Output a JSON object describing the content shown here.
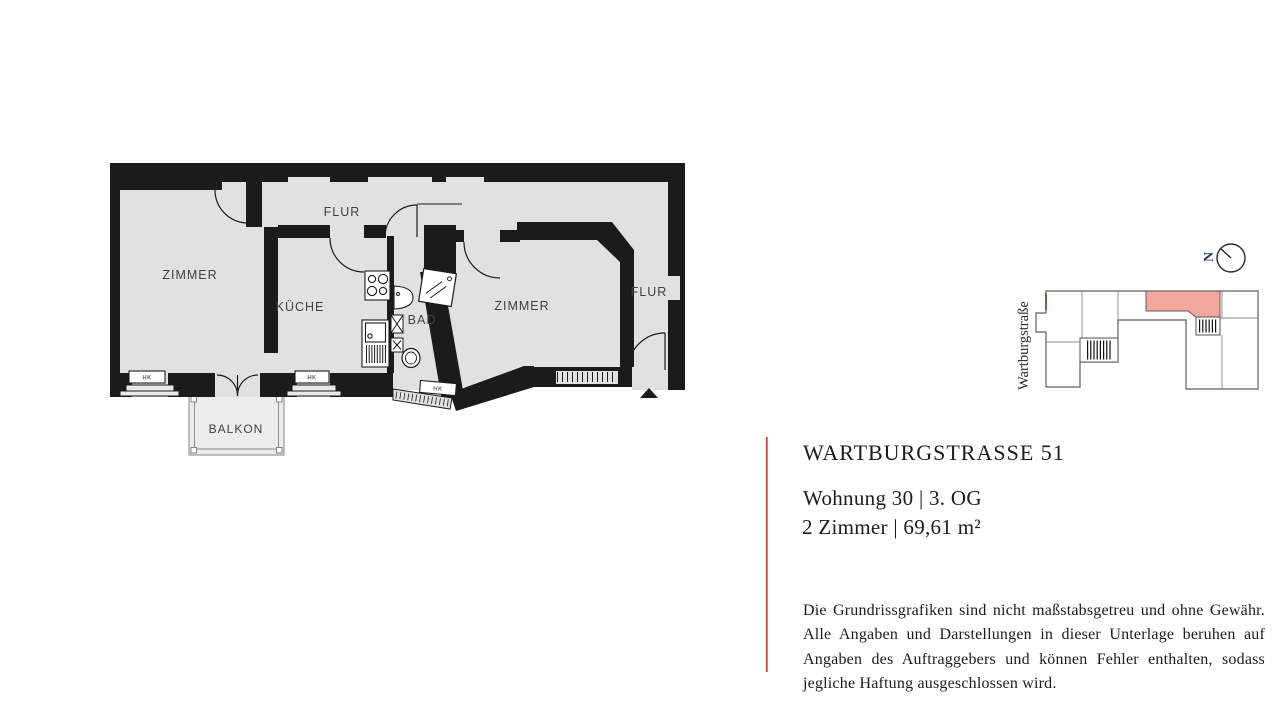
{
  "plan": {
    "labels": {
      "zimmer_left": "ZIMMER",
      "flur_top": "FLUR",
      "kueche": "KÜCHE",
      "bad": "BAD",
      "zimmer_right": "ZIMMER",
      "flur_right": "FLUR",
      "balkon": "BALKON",
      "radiator": "HK"
    }
  },
  "site_map": {
    "street_label": "Wartburgstraße",
    "north_label": "N"
  },
  "info": {
    "title": "WARTBURGSTRASSE 51",
    "unit_line": "Wohnung 30 | 3. OG",
    "size_line": "2 Zimmer | 69,61 m²"
  },
  "disclaimer": "Die Grundrissgrafiken sind nicht maßstabsgetreu und ohne Gewähr. Alle Angaben und Darstellungen in dieser Unterlage beruhen auf Angaben des Auftraggebers und können Fehler enthalten, sodass jegliche Haftung ausgeschlossen wird.",
  "colors": {
    "wall": "#1b1b19",
    "floor": "#e1e1e0",
    "accent_rule": "#bf3a34",
    "highlight": "#f2a69e",
    "label": "#3c4146"
  }
}
